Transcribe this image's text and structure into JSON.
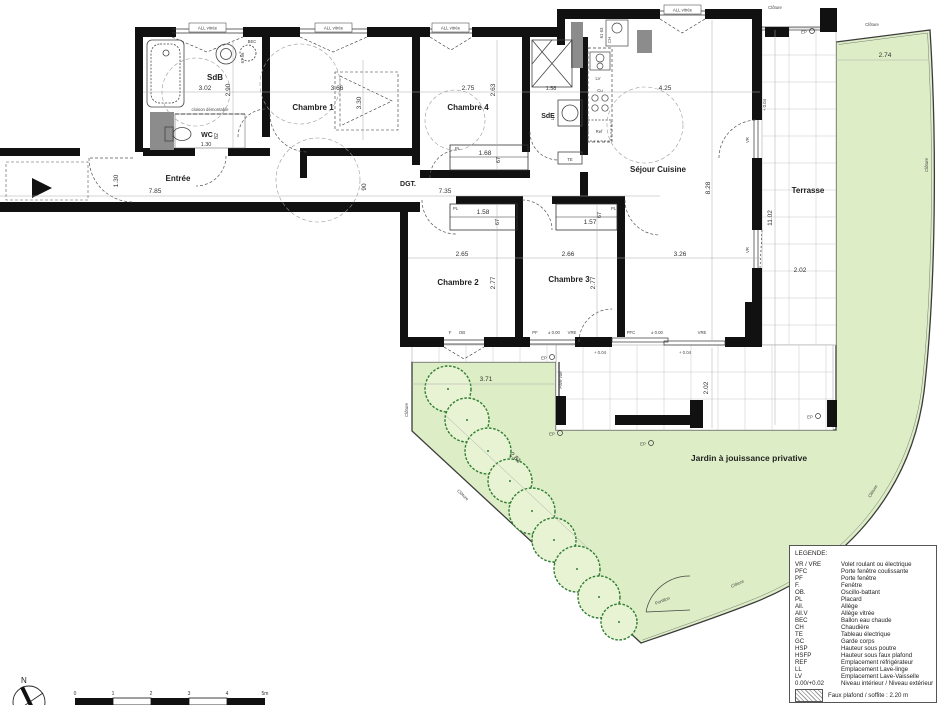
{
  "colors": {
    "garden": "#ddeec6",
    "garden_border": "#3c3c3c",
    "wall": "#111111",
    "pillar": "#8c8c8c",
    "tile_line": "#c7c7c7",
    "tree_stroke": "#2e7d32",
    "tree_fill": "#e7f3d2"
  },
  "rooms": {
    "sdb": {
      "name": "SdB",
      "dim_w": "3.02",
      "dim_h": "2.90"
    },
    "wc": {
      "name": "WC",
      "dim_w": "1.30",
      "dim_d": "82"
    },
    "entree": {
      "name": "Entrée",
      "dim_len": "7.85",
      "dim_wid": "1.30"
    },
    "chambre1": {
      "name": "Chambre 1",
      "dim_w": "3.66",
      "dim_h": "3.30"
    },
    "chambre4": {
      "name": "Chambre 4",
      "dim_w": "2.75",
      "dim_h": "2.63",
      "placard_w": "1.68",
      "placard_d": "67"
    },
    "sde": {
      "name": "SdE",
      "dim_w": "1.58"
    },
    "dgt": {
      "name": "DGT.",
      "dim_len": "7.35",
      "dim_wid": "90"
    },
    "sejour": {
      "name": "Séjour Cuisine",
      "dim_w": "4.25",
      "dim_h": "8.28",
      "dim_w2": "3.26"
    },
    "chambre2": {
      "name": "Chambre 2",
      "dim_w": "2.65",
      "dim_h": "2.77",
      "placard_w": "1.58",
      "placard_d": "67"
    },
    "chambre3": {
      "name": "Chambre 3",
      "dim_w": "2.66",
      "dim_h": "2.77",
      "placard_w": "1.57",
      "placard_d": "67"
    },
    "terrasse": {
      "name": "Terrasse",
      "dim_len": "11.02",
      "dim_wid": "2.02",
      "dim_wid2": "2.02"
    },
    "jardin": {
      "name": "Jardin à jouissance privative",
      "dim_top": "2.74",
      "dim_w": "3.71",
      "dim_diag": "2.81"
    }
  },
  "annotations": {
    "all_vitree": "ALL vitrée",
    "cloison": "cloison démontable",
    "cloture": "Clôture",
    "portillon": "Portillon",
    "pare_vue": "Pare vue",
    "ep": "EP",
    "pl": "PL",
    "pf": "PF",
    "pfc": "PFC",
    "vre": "VRE",
    "vr": "VR",
    "f": "F",
    "ob": "OB",
    "gc": "GC",
    "te": "TE",
    "ll": "LL",
    "lv": "LV",
    "cu": "Cu",
    "ref": "Ref",
    "ch": "CH",
    "bec": "BEC",
    "bec_dims": "67 56",
    "ch_dims": "61 63",
    "level_zero": "± 0.00",
    "level_ext": "+ 0.04",
    "north": "N"
  },
  "legend": {
    "title": "LEGENDE:",
    "items": [
      {
        "k": "VR / VRE",
        "v": "Volet roulant ou électrique"
      },
      {
        "k": "PFC",
        "v": "Porte fenêtre coulissante"
      },
      {
        "k": "PF",
        "v": "Porte fenêtre"
      },
      {
        "k": "F.",
        "v": "Fenêtre"
      },
      {
        "k": "OB.",
        "v": "Oscillo-battant"
      },
      {
        "k": "PL",
        "v": "Placard"
      },
      {
        "k": "All.",
        "v": "Allège"
      },
      {
        "k": "All.V",
        "v": "Allège vitrée"
      },
      {
        "k": "BEC",
        "v": "Ballon eau chaude"
      },
      {
        "k": "CH",
        "v": "Chaudière"
      },
      {
        "k": "TE",
        "v": "Tableau électrique"
      },
      {
        "k": "GC",
        "v": "Garde corps"
      },
      {
        "k": "HSP",
        "v": "Hauteur sous poutre"
      },
      {
        "k": "HSFP",
        "v": "Hauteur sous faux plafond"
      },
      {
        "k": "REF",
        "v": "Emplacement réfrigérateur"
      },
      {
        "k": "LL",
        "v": "Emplacement Lave-linge"
      },
      {
        "k": "LV",
        "v": "Emplacement Lave-Vaisselle"
      },
      {
        "k": "0.00/+0.02",
        "v": "Niveau intérieur / Niveau extérieur"
      }
    ],
    "soffit": "Faux plafond / soffite : 2.20 m"
  },
  "scalebar": {
    "labels": [
      "0",
      "1",
      "2",
      "3",
      "4",
      "5m"
    ]
  }
}
